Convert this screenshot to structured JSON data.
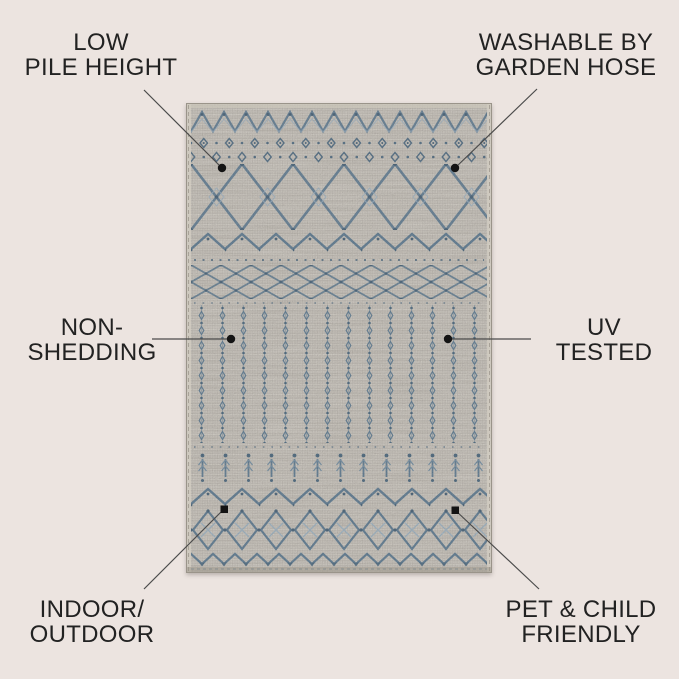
{
  "canvas": {
    "width": 679,
    "height": 679
  },
  "subject": {
    "description": "Gray and blue moroccan trellis low-pile area rug, top-down view"
  },
  "callouts": [
    {
      "id": "low-pile-height",
      "lines": [
        "LOW",
        "PILE HEIGHT"
      ],
      "position": "top-left"
    },
    {
      "id": "washable",
      "lines": [
        "WASHABLE BY",
        "GARDEN HOSE"
      ],
      "position": "top-right"
    },
    {
      "id": "non-shedding",
      "lines": [
        "NON-",
        "SHEDDING"
      ],
      "position": "middle-left"
    },
    {
      "id": "uv-tested",
      "lines": [
        "UV",
        "TESTED"
      ],
      "position": "middle-right"
    },
    {
      "id": "indoor-outdoor",
      "lines": [
        "INDOOR/",
        "OUTDOOR"
      ],
      "position": "bottom-left"
    },
    {
      "id": "pet-child-friendly",
      "lines": [
        "PET & CHILD",
        "FRIENDLY"
      ],
      "position": "bottom-right"
    }
  ],
  "colors": {
    "background": "#ECE4E0",
    "label_text": "#222222",
    "leader_line": "#4B4B4B",
    "marker": "#141414",
    "rug_base": "#B2ABA1",
    "rug_pattern_blue": "#46667F",
    "rug_pattern_dark": "#2C4A63",
    "rug_pattern_light": "#8AA3B6"
  }
}
